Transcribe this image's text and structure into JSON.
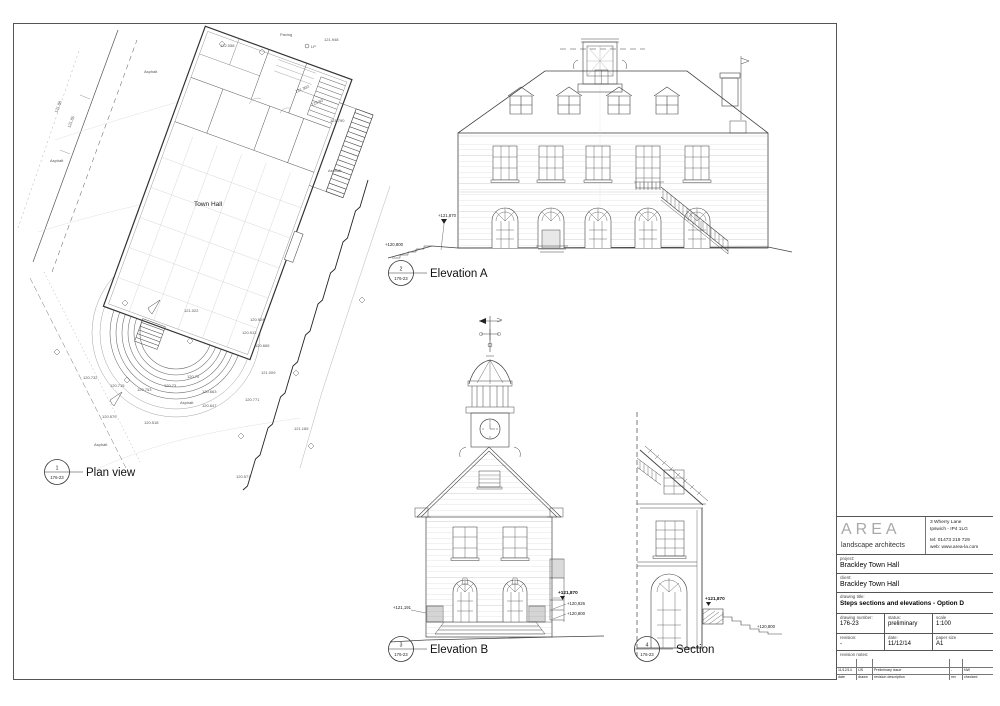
{
  "views": {
    "plan": {
      "number": "1",
      "ref": "176-23",
      "title": "Plan view"
    },
    "elevation_a": {
      "number": "2",
      "ref": "176-23",
      "title": "Elevation A"
    },
    "elevation_b": {
      "number": "3",
      "ref": "176-23",
      "title": "Elevation B"
    },
    "section": {
      "number": "4",
      "ref": "176-23",
      "title": "Section"
    }
  },
  "plan": {
    "building_label": "Town Hall",
    "annotations": [
      "Paving",
      "121.948",
      "122.058",
      "Asphalt",
      "Asphalt",
      "121.790",
      "Asphalt",
      "121.022",
      "120.924",
      "120.912",
      "120.665",
      "120.732",
      "120.715",
      "120.753",
      "120.73",
      "120.70",
      "120.663",
      "Asphalt",
      "120.647",
      "120.579",
      "120.518",
      "Asphalt",
      "121.009",
      "120.771",
      "121.165",
      "120.571",
      "121.88",
      "121.85",
      "121.302",
      "123.50",
      "LP"
    ]
  },
  "elevation_a": {
    "levels": {
      "upper": "+121,870",
      "ground": "+120,800"
    }
  },
  "elevation_b": {
    "levels": {
      "left": "+121,191",
      "upper": "+121,870",
      "mid": "+120,926",
      "ground": "+120,800"
    }
  },
  "section": {
    "levels": {
      "upper": "+121,870",
      "ground": "+120,800"
    }
  },
  "title_block": {
    "logo": {
      "name": "AREA",
      "tagline": "landscape architects"
    },
    "contact": {
      "address1": "3 Wherry Lane",
      "address2": "Ipswich - IP4 1LG",
      "tel": "tel: 01473 219 729",
      "web": "web: www.area-la.com"
    },
    "project_label": "project:",
    "project": "Brackley Town Hall",
    "client_label": "client:",
    "client": "Brackley Town Hall",
    "drawing_title_label": "drawing title:",
    "drawing_title": "Steps sections and elevations - Option D",
    "fields": {
      "drawing_number_label": "drawing number:",
      "drawing_number": "176-23",
      "status_label": "status:",
      "status": "preliminary",
      "scale_label": "scale",
      "scale": "1:100",
      "revision_label": "revision:",
      "revision": "-",
      "date_label": "date:",
      "date": "11/12/14",
      "paper_size_label": "paper size",
      "paper_size": "A1"
    },
    "revision_notes_label": "revision notes:",
    "revision_table": {
      "row": {
        "date": "11/12/14",
        "drawn": "IJS",
        "description": "Preliminary issue",
        "rev": "-",
        "checked": "NW"
      },
      "headers": {
        "date": "date",
        "drawn": "drawn",
        "description": "revision description",
        "rev": "rev",
        "checked": "checked"
      }
    }
  }
}
